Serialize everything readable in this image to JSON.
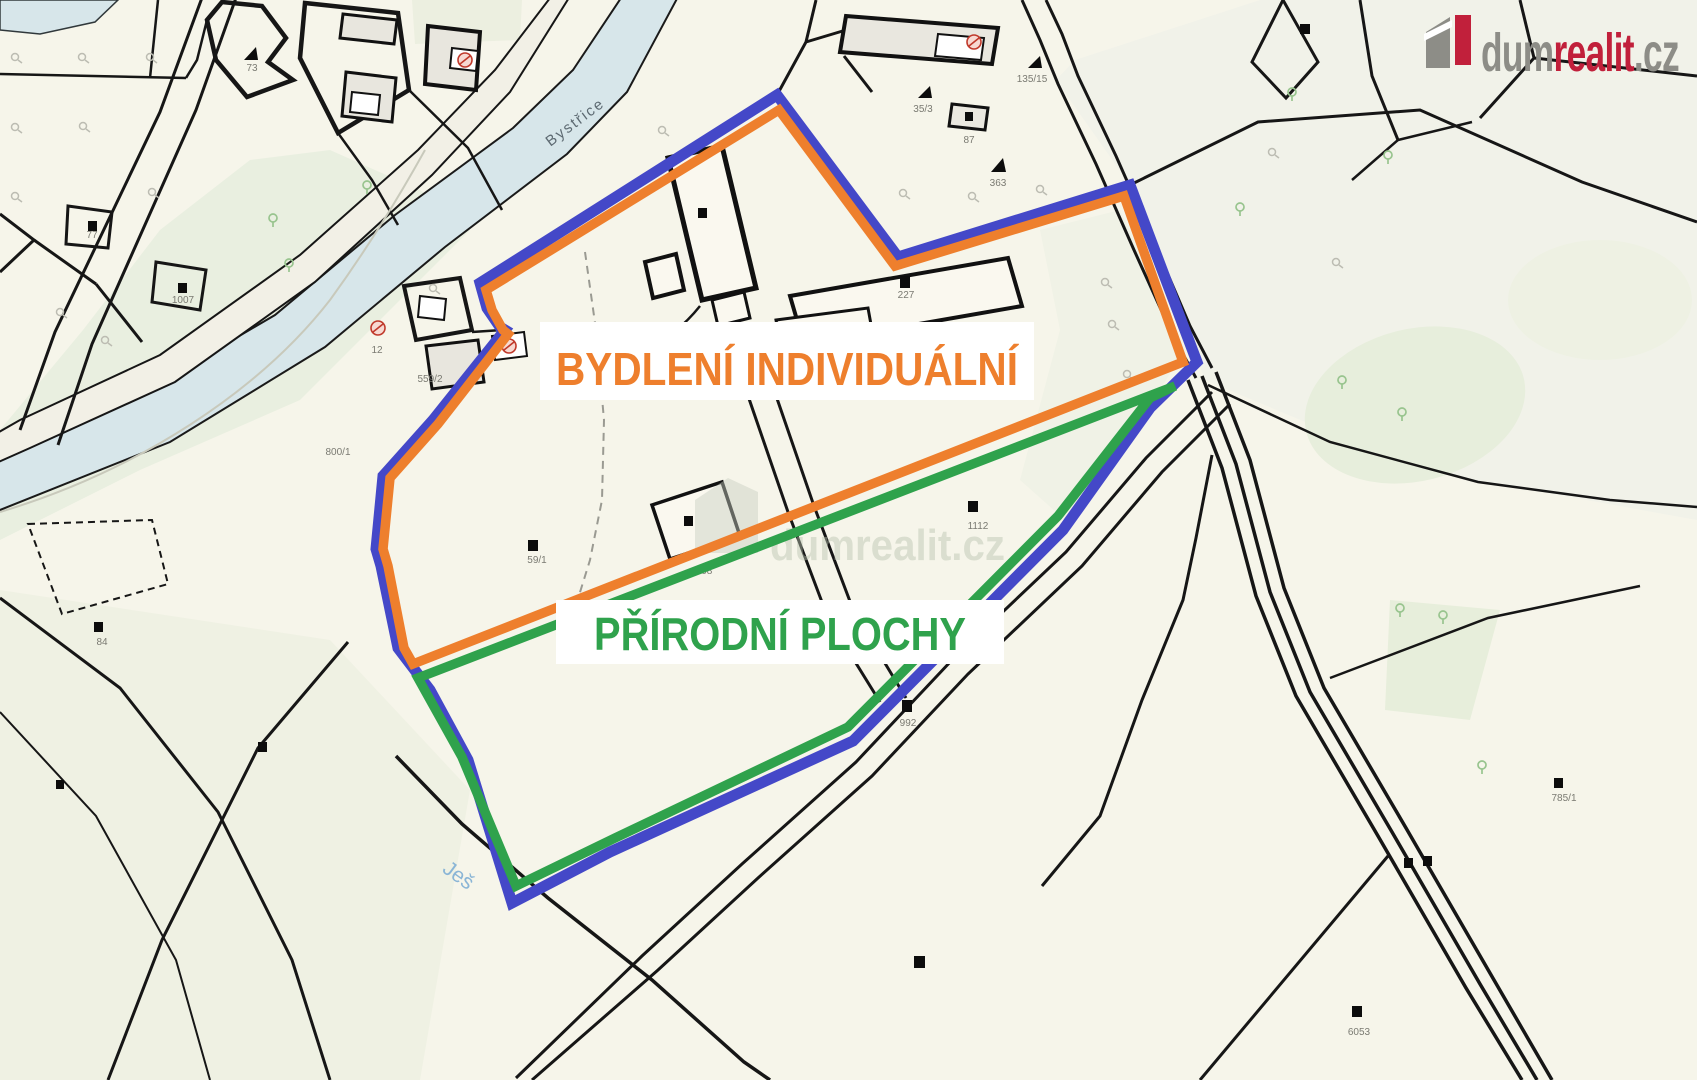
{
  "page": {
    "type": "cadastral-zoning-map"
  },
  "branding": {
    "logo": {
      "part1": "dum",
      "part2": "realit",
      "part3": ".cz"
    },
    "logo_colors": {
      "gray": "#8d8d87",
      "red": "#c1203b"
    },
    "watermark": "dumrealit.cz"
  },
  "overlay": {
    "boundary_color": "#4448c8",
    "zones": [
      {
        "label": "BYDLENÍ INDIVIDUÁLNÍ",
        "color": "#ee7f2d"
      },
      {
        "label": "PŘÍRODNÍ PLOCHY",
        "color": "#2fa24c"
      }
    ]
  },
  "map": {
    "water_labels": {
      "river": "Bystřice",
      "stream": "Ješ"
    },
    "parcel_labels": [
      "73",
      "12",
      "1007",
      "77",
      "800/1",
      "559/2",
      "35/3",
      "87",
      "135/15",
      "363",
      "227",
      "59/1",
      "108",
      "1112",
      "84",
      "992",
      "6053",
      "785/1"
    ]
  }
}
